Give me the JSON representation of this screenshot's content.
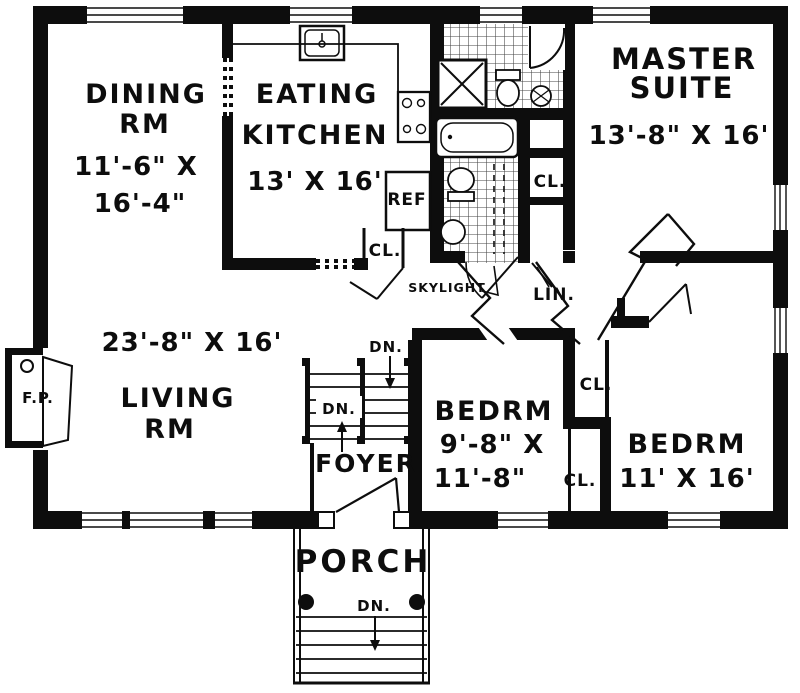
{
  "title": "House first floor plan",
  "rooms": {
    "dining": {
      "name1": "DINING",
      "name2": "RM",
      "dim1": "11'-6\" X",
      "dim2": "16'-4\""
    },
    "kitchen": {
      "name1": "EATING",
      "name2": "KITCHEN",
      "dim": "13' X 16'"
    },
    "master": {
      "name1": "MASTER",
      "name2": "SUITE",
      "dim": "13'-8\" X 16'"
    },
    "living": {
      "dim": "23'-8\" X 16'",
      "name1": "LIVING",
      "name2": "RM"
    },
    "bedroom1": {
      "name": "BEDRM",
      "dim1": "9'-8\" X",
      "dim2": "11'-8\""
    },
    "bedroom2": {
      "name": "BEDRM",
      "dim": "11' X 16'"
    },
    "foyer": {
      "name": "FOYER"
    },
    "porch": {
      "name": "PORCH"
    }
  },
  "labels": {
    "refrigerator": "REF",
    "closet_kitchen": "CL.",
    "closet_master": "CL.",
    "closet_bedroom_upper": "CL.",
    "closet_bedroom_lower": "CL.",
    "linen": "LIN.",
    "skylight": "SKYLIGHT",
    "fireplace": "F.P.",
    "down_stairs_upper": "DN.",
    "down_stairs_lower": "DN.",
    "down_porch": "DN."
  },
  "colors": {
    "walls": "#0d0d0d",
    "background": "#ffffff",
    "tile_line": "#333333"
  }
}
